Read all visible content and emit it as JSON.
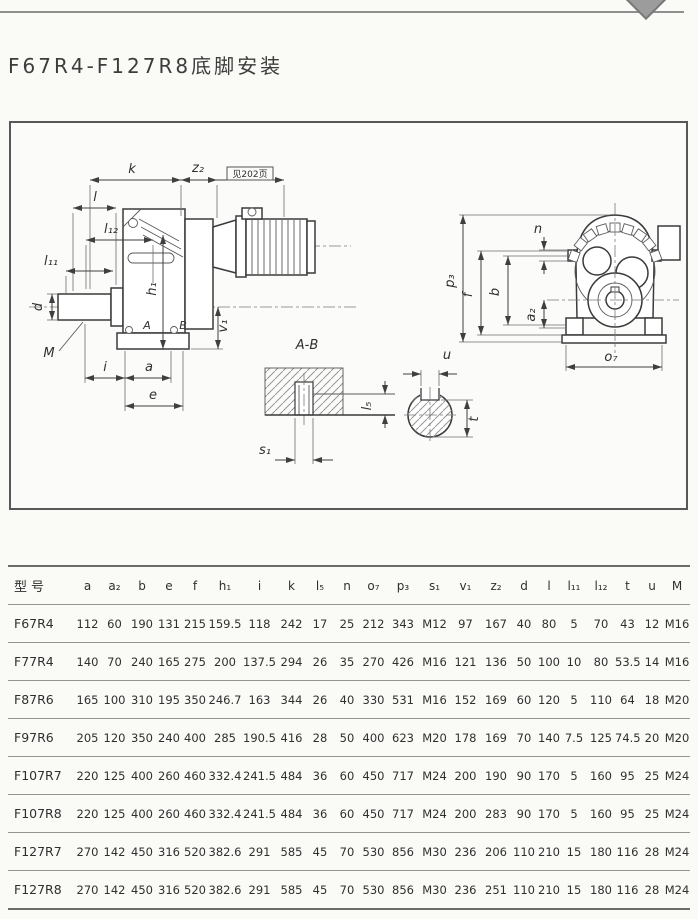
{
  "page": {
    "title": "F67R4-F127R8底脚安装"
  },
  "drawing": {
    "labels": {
      "k": "k",
      "z2": "z₂",
      "see_page": "见202页",
      "l": "l",
      "l12": "l₁₂",
      "l11": "l₁₁",
      "d": "d",
      "m": "M",
      "i": "i",
      "a": "a",
      "e": "e",
      "h1": "h₁",
      "v1": "v₁",
      "a_mark": "A",
      "b_mark": "B",
      "section_title": "A-B",
      "s1": "s₁",
      "l5": "l₅",
      "u": "u",
      "t": "t",
      "p3": "p₃",
      "f": "f",
      "b": "b",
      "n": "n",
      "a2": "a₂",
      "o7": "o₇"
    }
  },
  "table": {
    "headers": [
      "型号",
      "a",
      "a₂",
      "b",
      "e",
      "f",
      "h₁",
      "i",
      "k",
      "l₅",
      "n",
      "o₇",
      "p₃",
      "s₁",
      "v₁",
      "z₂",
      "d",
      "l",
      "l₁₁",
      "l₁₂",
      "t",
      "u",
      "M"
    ],
    "rows": [
      [
        "F67R4",
        "112",
        "60",
        "190",
        "131",
        "215",
        "159.5",
        "118",
        "242",
        "17",
        "25",
        "212",
        "343",
        "M12",
        "97",
        "167",
        "40",
        "80",
        "5",
        "70",
        "43",
        "12",
        "M16"
      ],
      [
        "F77R4",
        "140",
        "70",
        "240",
        "165",
        "275",
        "200",
        "137.5",
        "294",
        "26",
        "35",
        "270",
        "426",
        "M16",
        "121",
        "136",
        "50",
        "100",
        "10",
        "80",
        "53.5",
        "14",
        "M16"
      ],
      [
        "F87R6",
        "165",
        "100",
        "310",
        "195",
        "350",
        "246.7",
        "163",
        "344",
        "26",
        "40",
        "330",
        "531",
        "M16",
        "152",
        "169",
        "60",
        "120",
        "5",
        "110",
        "64",
        "18",
        "M20"
      ],
      [
        "F97R6",
        "205",
        "120",
        "350",
        "240",
        "400",
        "285",
        "190.5",
        "416",
        "28",
        "50",
        "400",
        "623",
        "M20",
        "178",
        "169",
        "70",
        "140",
        "7.5",
        "125",
        "74.5",
        "20",
        "M20"
      ],
      [
        "F107R7",
        "220",
        "125",
        "400",
        "260",
        "460",
        "332.4",
        "241.5",
        "484",
        "36",
        "60",
        "450",
        "717",
        "M24",
        "200",
        "190",
        "90",
        "170",
        "5",
        "160",
        "95",
        "25",
        "M24"
      ],
      [
        "F107R8",
        "220",
        "125",
        "400",
        "260",
        "460",
        "332.4",
        "241.5",
        "484",
        "36",
        "60",
        "450",
        "717",
        "M24",
        "200",
        "283",
        "90",
        "170",
        "5",
        "160",
        "95",
        "25",
        "M24"
      ],
      [
        "F127R7",
        "270",
        "142",
        "450",
        "316",
        "520",
        "382.6",
        "291",
        "585",
        "45",
        "70",
        "530",
        "856",
        "M30",
        "236",
        "206",
        "110",
        "210",
        "15",
        "180",
        "116",
        "28",
        "M24"
      ],
      [
        "F127R8",
        "270",
        "142",
        "450",
        "316",
        "520",
        "382.6",
        "291",
        "585",
        "45",
        "70",
        "530",
        "856",
        "M30",
        "236",
        "251",
        "110",
        "210",
        "15",
        "180",
        "116",
        "28",
        "M24"
      ]
    ]
  }
}
